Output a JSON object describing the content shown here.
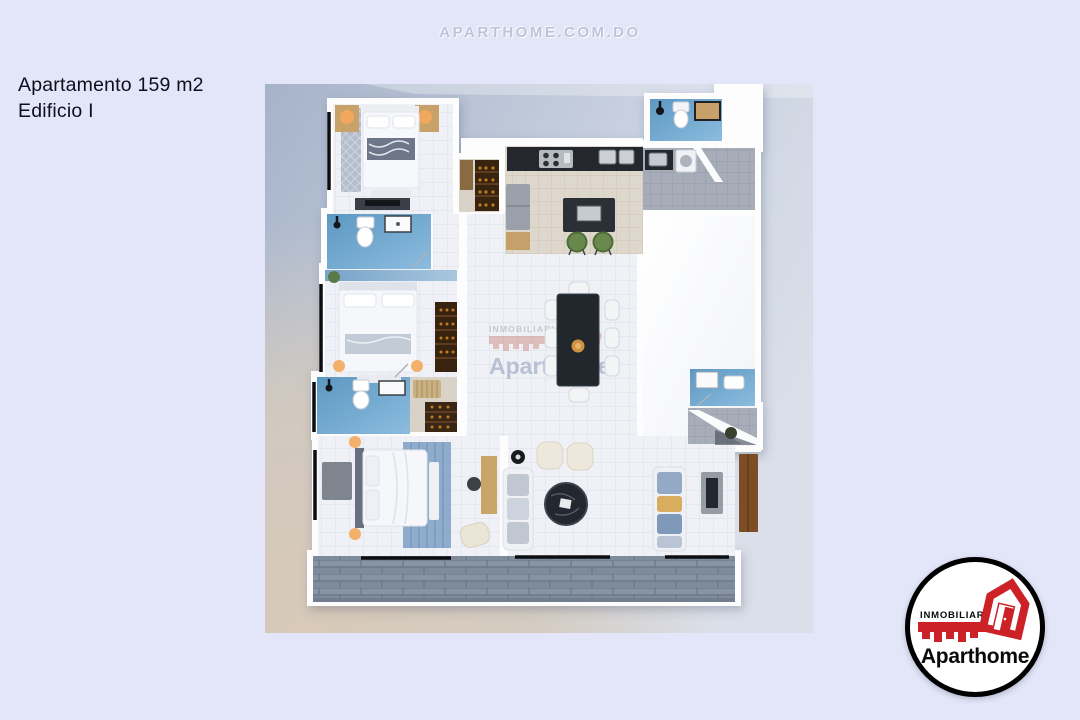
{
  "page": {
    "background": "#e3e6f9",
    "top_watermark": "APARTHOME.COM.DO"
  },
  "listing": {
    "title": "Apartamento 159 m2",
    "subtitle": "Edificio I"
  },
  "plan_watermark": {
    "brand_upper": "INMOBILIARIA",
    "brand_name": "Aparthome"
  },
  "logo": {
    "upper": "INMOBILIARIA",
    "name_regular": "Apart",
    "name_bold": "home",
    "red": "#cc2127"
  },
  "colors": {
    "title_text": "#0e0e1c",
    "bathroom_floor": "#6fa5cc",
    "balcony_wood": "#7e8b9b",
    "kitchen_counter": "#24282e",
    "stool_green": "#68894b",
    "lamp_glow": "#f3a95c",
    "accent_wall_blue": "#8fb4d4",
    "closet_wood": "#38230f"
  }
}
